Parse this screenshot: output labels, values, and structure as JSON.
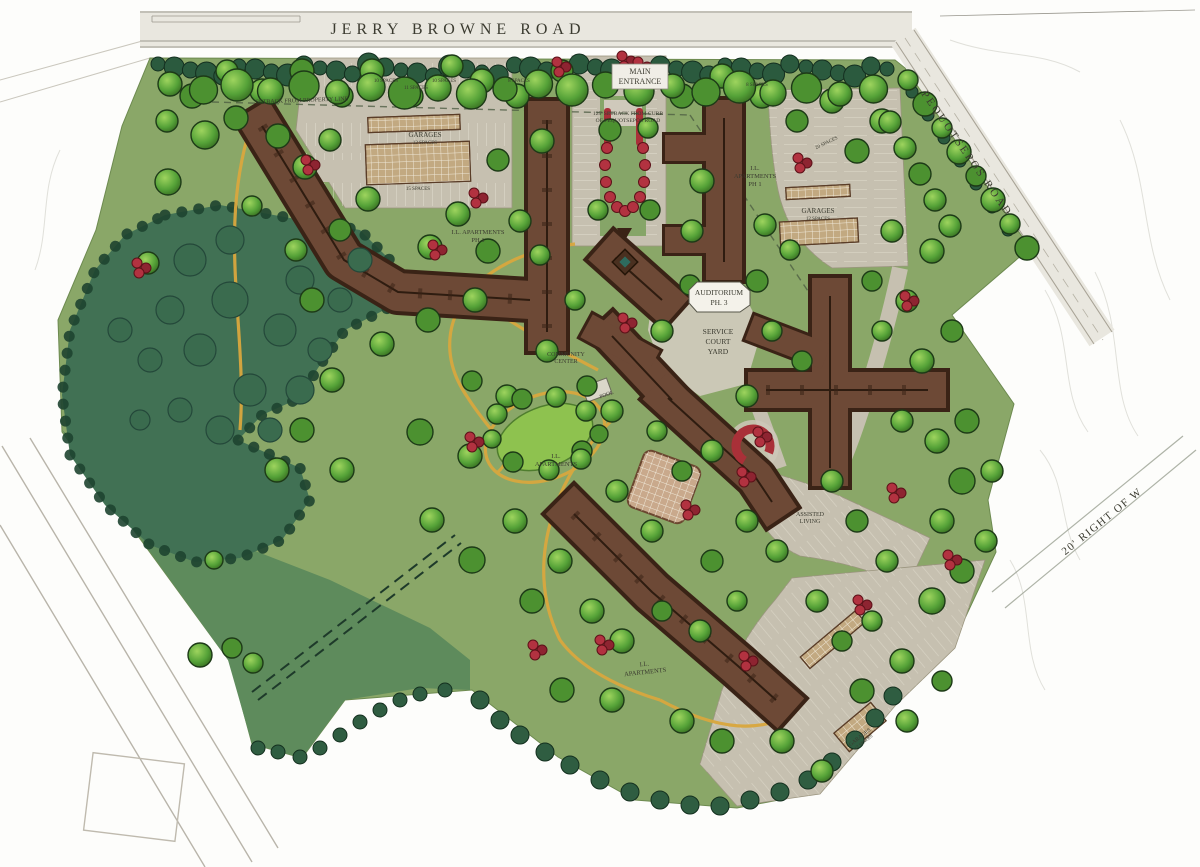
{
  "title": "Retirement community site master plan (hand-rendered)",
  "roads": {
    "top_road": "JERRY  BROWNE  ROAD",
    "right_road": "PEQUOTSEPOS  ROAD",
    "right_of_way": "20' RIGHT OF W"
  },
  "labels": {
    "main_entrance": {
      "line1": "MAIN",
      "line2": "ENTRANCE"
    },
    "setback_property": {
      "text": "SETBACK FROM PROPERTY LINE"
    },
    "setback_pequotsepos": {
      "line1": "125' SETBACK FROM CURB",
      "line2": "OF PEQUOTSEPOS ROAD"
    },
    "garages_left": {
      "line1": "GARAGES",
      "line2": "12 SPACES"
    },
    "garages_right": {
      "line1": "GARAGES",
      "line2": "12 SPACES"
    },
    "garages_bottom": {
      "line1": "GARAGES",
      "line2": "12 SPACES"
    },
    "apartments_left": {
      "line1": "I.L. APARTMENTS",
      "line2": "PH 1"
    },
    "apartments_right": {
      "line1": "I.L.",
      "line2": "APARTMENTS",
      "line3": "PH 1"
    },
    "auditorium": {
      "line1": "AUDITORIUM",
      "line2": "PH. 3"
    },
    "service_court": {
      "line1": "SERVICE",
      "line2": "COURT",
      "line3": "YARD"
    },
    "community_center": {
      "line1": "COMMUNITY",
      "line2": "CENTER"
    },
    "pool": {
      "text": "POOL"
    },
    "apartments_mid": {
      "line1": "I.L.",
      "line2": "APARTMENTS"
    },
    "assisted_living": {
      "line1": "ASSISTED",
      "line2": "LIVING"
    },
    "apartments_bottom": {
      "line1": "I.L.",
      "line2": "APARTMENTS"
    }
  },
  "parking_counts": [
    {
      "text": "10 SPACES"
    },
    {
      "text": "11 SPACES"
    },
    {
      "text": "10 SPACES"
    },
    {
      "text": "8 SPACES"
    },
    {
      "text": "15 SPACES"
    },
    {
      "text": "20 SPACES"
    },
    {
      "text": "8 SPACES"
    }
  ],
  "colors": {
    "paper": "#ffffff",
    "grass": "#8aa768",
    "meadow": "#5e8b5c",
    "forest": "#417154",
    "tree_green": "#55a238",
    "evergreen": "#2b5a3e",
    "roof_brown": "#6d4936",
    "roof_edge": "#3a2316",
    "parking_grey": "#c6c0b0",
    "road_grey": "#e9e7df",
    "path_yellow": "#d9a73e",
    "shrub_red": "#b23240",
    "label_ink": "#3b3b30"
  }
}
